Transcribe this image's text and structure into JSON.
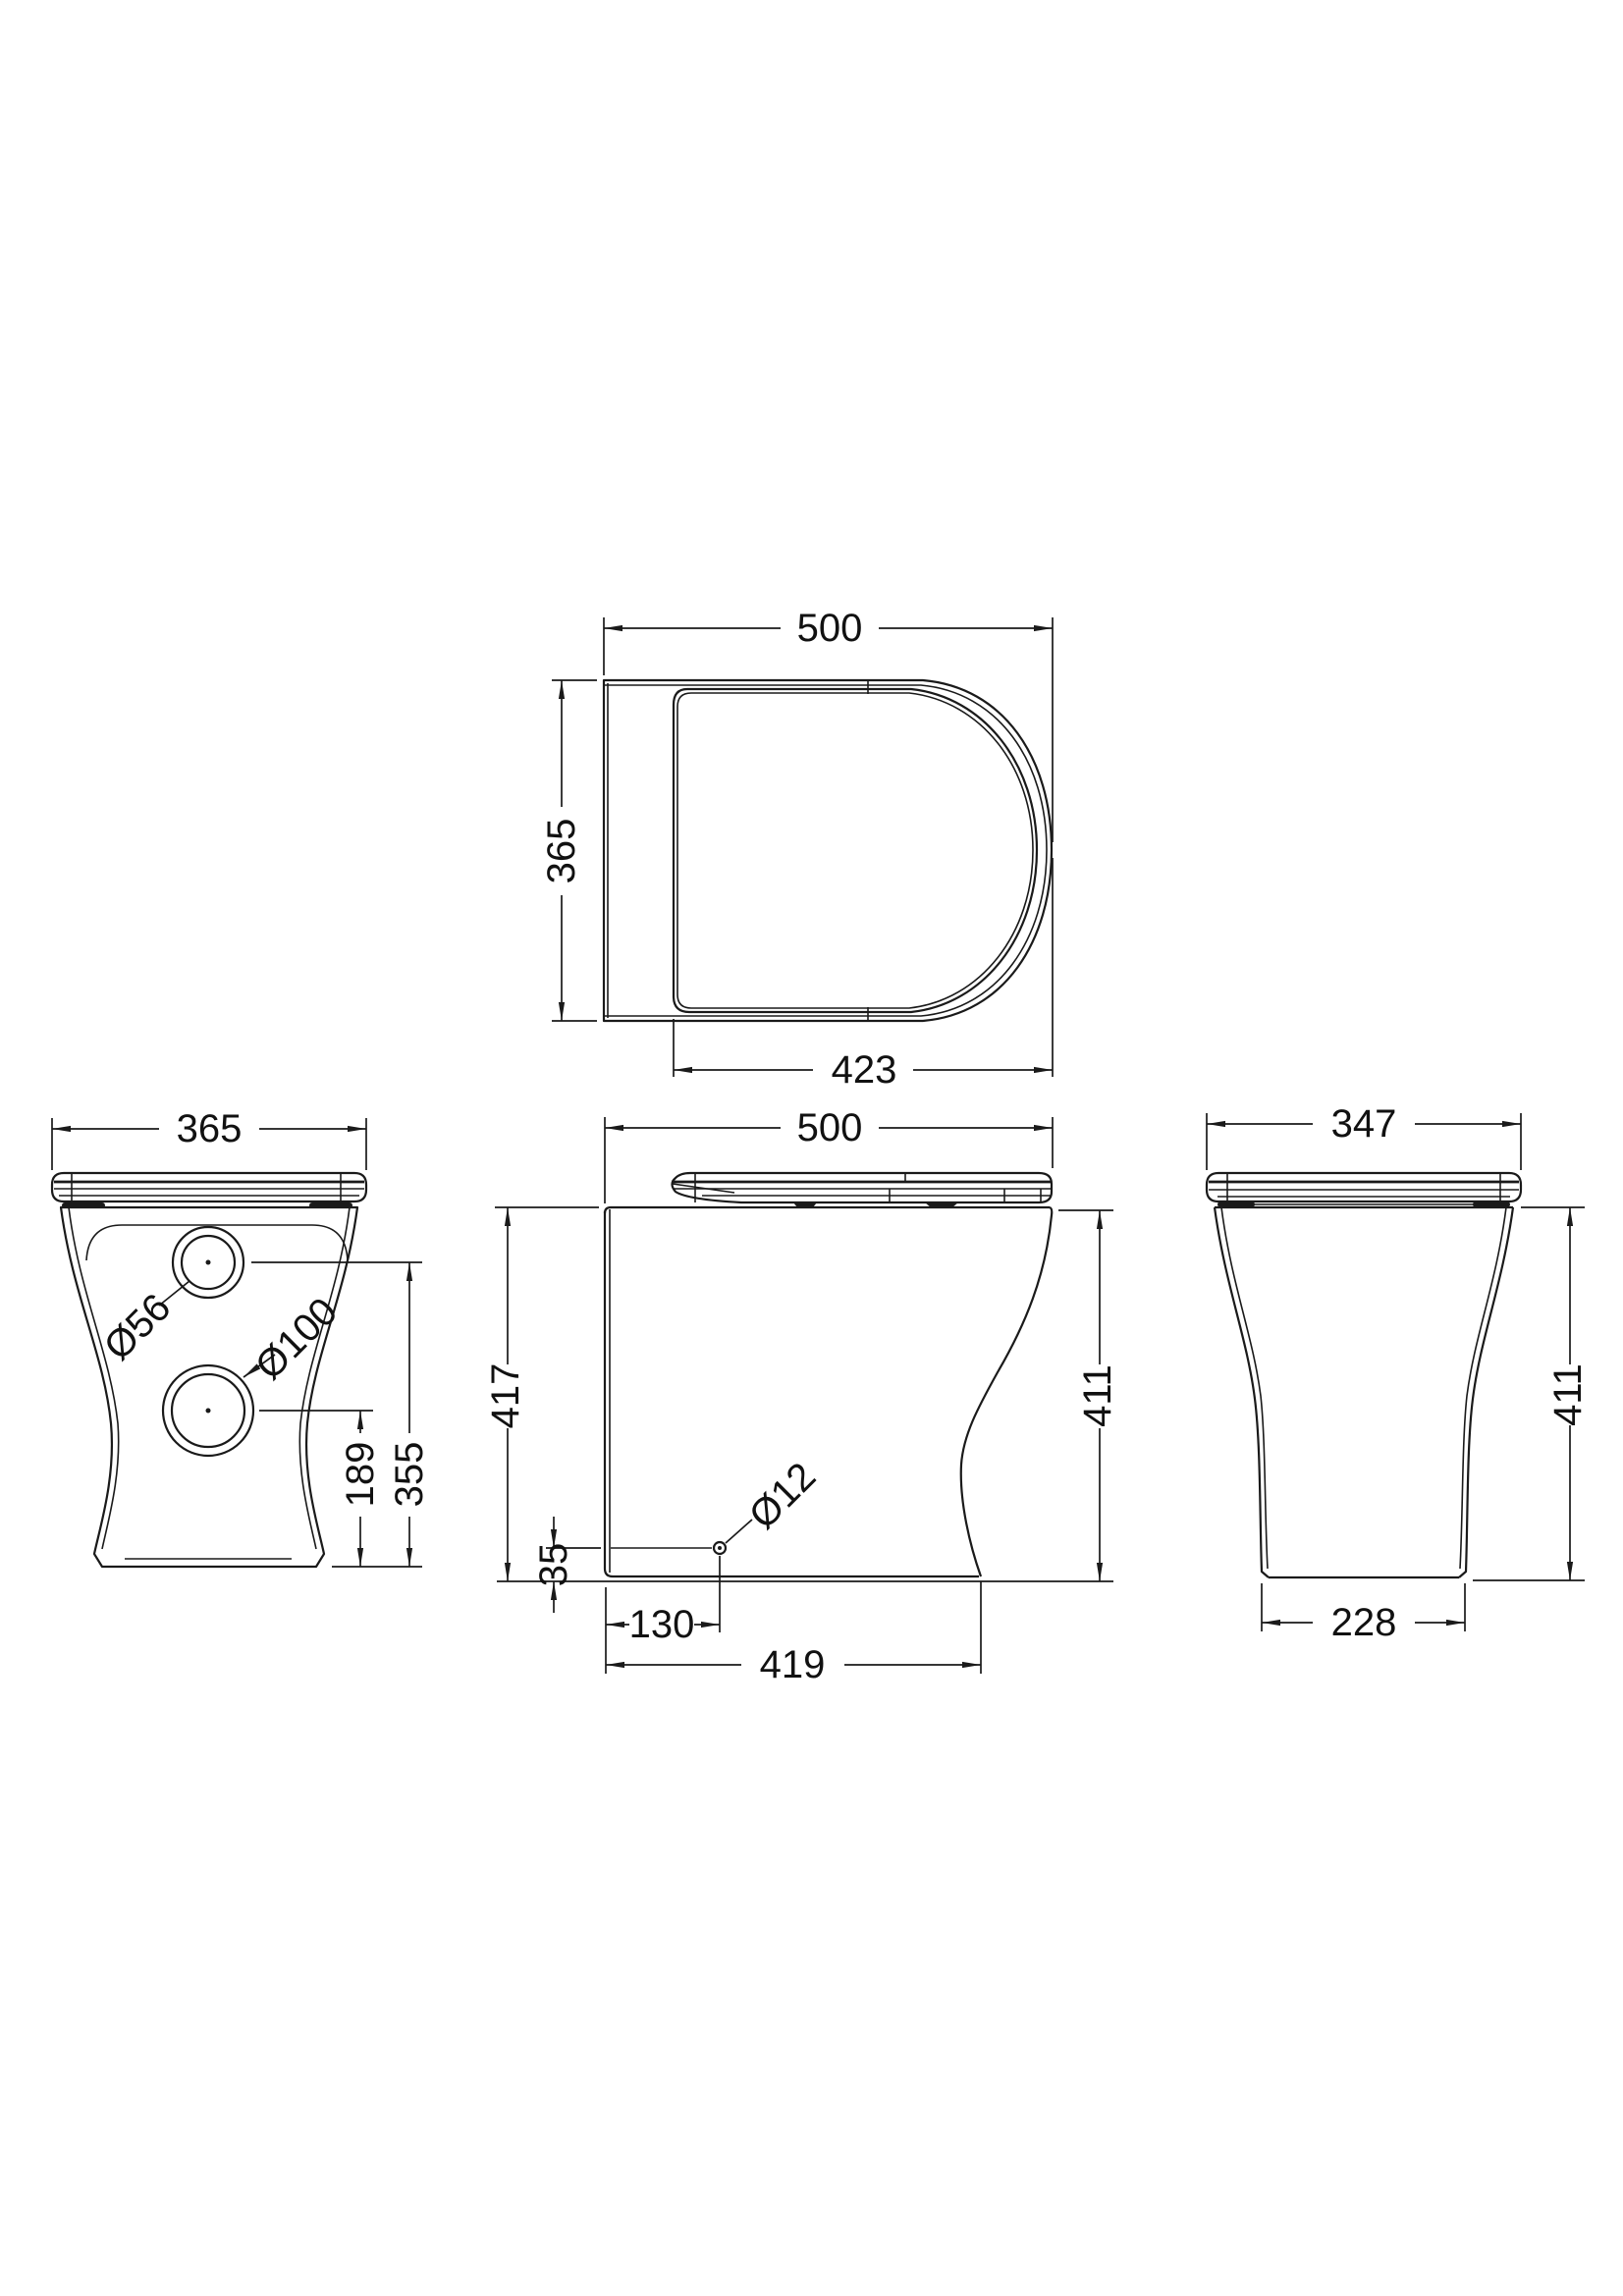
{
  "drawing": {
    "plan": {
      "width": "500",
      "depth": "365",
      "seat_length": "423"
    },
    "back": {
      "width": "365",
      "hole_upper": "Ø56",
      "hole_lower": "Ø100",
      "hole_upper_height": "355",
      "hole_lower_height": "189"
    },
    "side": {
      "width": "500",
      "height_overall": "417",
      "height_rim": "411",
      "fixing_hole": "Ø12",
      "fixing_height": "35",
      "fixing_setout": "130",
      "base_depth": "419"
    },
    "front": {
      "width": "347",
      "height_rim": "411",
      "base_width": "228"
    }
  }
}
